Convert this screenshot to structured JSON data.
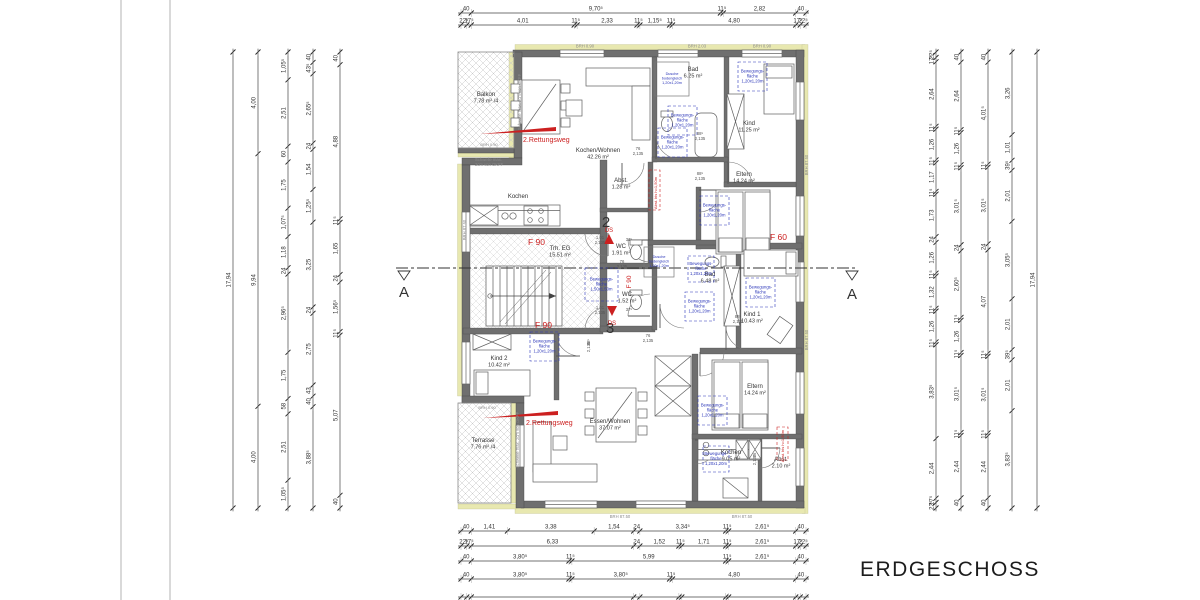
{
  "title": "ERDGESCHOSS",
  "section": {
    "letter": "A"
  },
  "apartments": [
    {
      "number": "2"
    },
    {
      "number": "3"
    }
  ],
  "rooms": [
    {
      "id": "balkon",
      "name": "Balkon",
      "area": "7.78 m² /4"
    },
    {
      "id": "kochen-wohnen",
      "name": "Kochen/Wohnen",
      "area": "42.26 m²"
    },
    {
      "id": "kochen-2",
      "name": "Kochen",
      "area": ""
    },
    {
      "id": "bad-2",
      "name": "Bad",
      "area": "6.25 m²"
    },
    {
      "id": "kind-og2",
      "name": "Kind",
      "area": "11.25 m²"
    },
    {
      "id": "eltern-2",
      "name": "Eltern",
      "area": "14.24 m²"
    },
    {
      "id": "abst-2",
      "name": "Abst.",
      "area": "1.28 m²"
    },
    {
      "id": "wc-2",
      "name": "WC",
      "area": "1.91 m²"
    },
    {
      "id": "treppenhaus",
      "name": "Trh. EG",
      "area": "15.51 m²"
    },
    {
      "id": "wc-3",
      "name": "WC",
      "area": "1.52 m²"
    },
    {
      "id": "bad-3",
      "name": "Bad",
      "area": "6.48 m²"
    },
    {
      "id": "kind-1",
      "name": "Kind 1",
      "area": "10.43 m²"
    },
    {
      "id": "kind-2",
      "name": "Kind 2",
      "area": "10.42 m²"
    },
    {
      "id": "eltern-3",
      "name": "Eltern",
      "area": "14.24 m²"
    },
    {
      "id": "essen-wohnen",
      "name": "Essen/Wohnen",
      "area": "37.07 m²"
    },
    {
      "id": "kochen-3",
      "name": "Kochen",
      "area": "9.05 m²"
    },
    {
      "id": "abst-3",
      "name": "Abst.",
      "area": "2.10 m²"
    },
    {
      "id": "terrasse",
      "name": "Terrasse",
      "area": "7.76 m² /4"
    }
  ],
  "annotations": {
    "rettungsweg": "2.Rettungsweg",
    "f90": "F 90",
    "f60": "F 60",
    "ds": "DS",
    "bewegung": [
      "Bewegungs-",
      "fläche",
      "1,20x1,20m"
    ],
    "bewegung150": [
      "Bewegungs-",
      "fläche",
      "1,50x1,50m"
    ],
    "dusche": [
      "Dusche",
      "bodengleich",
      "1,20x1,20m"
    ],
    "schwelle": "Schwelle max. 2cm von OKFF",
    "schwelle_l1": "Schwelle max.",
    "schwelle_l2": "2cm von OKFF",
    "abst_red": "Abst. bis h=1,50m",
    "brh_090": "BRH 0.90",
    "brh_203": "BRH 2.03",
    "brh_8750": "BRH 87.50",
    "door_76": "76",
    "door_88": "88⁵",
    "door_101": "1,01",
    "door_h": "2,135",
    "wall_37": "37⁵"
  },
  "colors": {
    "red": "#cc2020",
    "blue": "#2a35b8",
    "wall": "#6f6f6f",
    "insulation": "#e8e8b0",
    "dim_text": "#333333",
    "gray_text": "#8a8a8a"
  },
  "dimensions": {
    "top": [
      {
        "values": [
          "40",
          "9,70⁵",
          "11⁵",
          "2,82",
          "40"
        ]
      },
      {
        "values": [
          "22⁵",
          "17⁵",
          "4,01",
          "11⁵",
          "2,33",
          "11⁵",
          "1,15⁵",
          "11⁵",
          "4,80",
          "17⁵",
          "22⁵"
        ]
      }
    ],
    "bottom": [
      {
        "values": [
          "40",
          "1,41",
          "3,38",
          "1,54",
          "24",
          "3,34⁵",
          "11⁵",
          "2,61⁵",
          "40"
        ]
      },
      {
        "values": [
          "22⁵",
          "17⁵",
          "6,33",
          "24",
          "1,52",
          "11⁵",
          "1,71",
          "11⁵",
          "2,61⁵",
          "17⁵",
          "22⁵"
        ]
      },
      {
        "values": [
          "40",
          "3,80⁵",
          "11⁵",
          "5,99",
          "11⁵",
          "2,61⁵",
          "40"
        ]
      },
      {
        "values": [
          "40",
          "3,80⁵",
          "11⁵",
          "3,80⁵",
          "11⁵",
          "4,80",
          "40"
        ]
      }
    ],
    "bottom_partial_row": true,
    "left": [
      {
        "values": [
          "17,94"
        ]
      },
      {
        "values": [
          "4,00",
          "9,94",
          "4,00"
        ]
      },
      {
        "values": [
          "1,05⁵",
          "2,51",
          "60",
          "1,75",
          "1,07⁵",
          "1,18",
          "24",
          "2,96⁵",
          "1,75",
          "58",
          "2,51",
          "1,05⁵"
        ]
      },
      {
        "values": [
          "40",
          "43⁵",
          "2,65⁵",
          "24",
          "1,54",
          "1,25⁵",
          "3,25",
          "24",
          "2,75",
          "43",
          "40",
          "3,88⁵"
        ]
      },
      {
        "values": [
          "40",
          "4,88",
          "11⁵",
          "1,65",
          "24",
          "1,56⁵",
          "11⁵",
          "5,07",
          "40"
        ]
      }
    ],
    "right": [
      {
        "values": [
          "22⁵",
          "17⁵",
          "2,64",
          "11⁵",
          "1,26",
          "11⁵",
          "1,17",
          "11⁵",
          "1,73",
          "24",
          "1,26",
          "11⁵",
          "1,32",
          "11⁵",
          "1,26",
          "11⁵",
          "3,83⁵",
          "2,44",
          "17⁵",
          "22⁵"
        ]
      },
      {
        "values": [
          "40",
          "2,64",
          "11⁵",
          "1,26",
          "11⁵",
          "3,01⁵",
          "24",
          "2,60⁵",
          "11⁵",
          "1,26",
          "11⁵",
          "3,01⁵",
          "11⁵",
          "2,44",
          "40"
        ]
      },
      {
        "values": [
          "40",
          "4,01⁵",
          "11⁵",
          "3,01⁵",
          "24",
          "4,07",
          "11⁵",
          "3,01⁵",
          "11⁵",
          "2,44",
          "40"
        ]
      },
      {
        "values": [
          "3,26",
          "1,01",
          "39⁵",
          "2,01",
          "3,05⁵",
          "2,01",
          "39⁵",
          "2,01",
          "3,83⁵"
        ]
      },
      {
        "values": [
          "17,94"
        ]
      }
    ]
  }
}
